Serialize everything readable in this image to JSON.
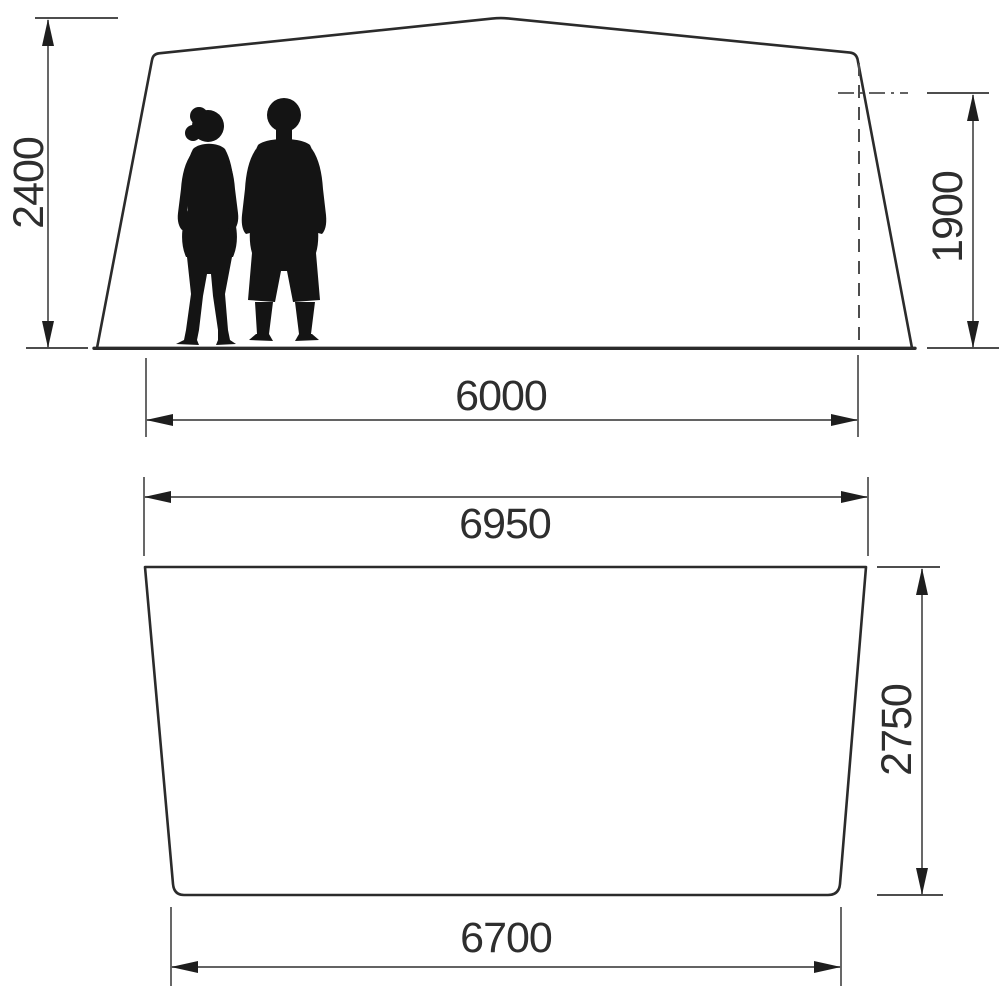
{
  "diagram": {
    "type": "technical-dimension-drawing",
    "colors": {
      "background": "#ffffff",
      "outline": "#2b2b2b",
      "dim-line": "#4d4d4d",
      "arrow": "#1e1e1e",
      "silhouette": "#141414",
      "label": "#2e2e2e"
    },
    "dimensions": {
      "peak_height": "2400",
      "side_height": "1900",
      "floor_width": "6000",
      "plan_top_width": "6950",
      "plan_depth": "2750",
      "plan_bottom_width": "6700"
    }
  }
}
